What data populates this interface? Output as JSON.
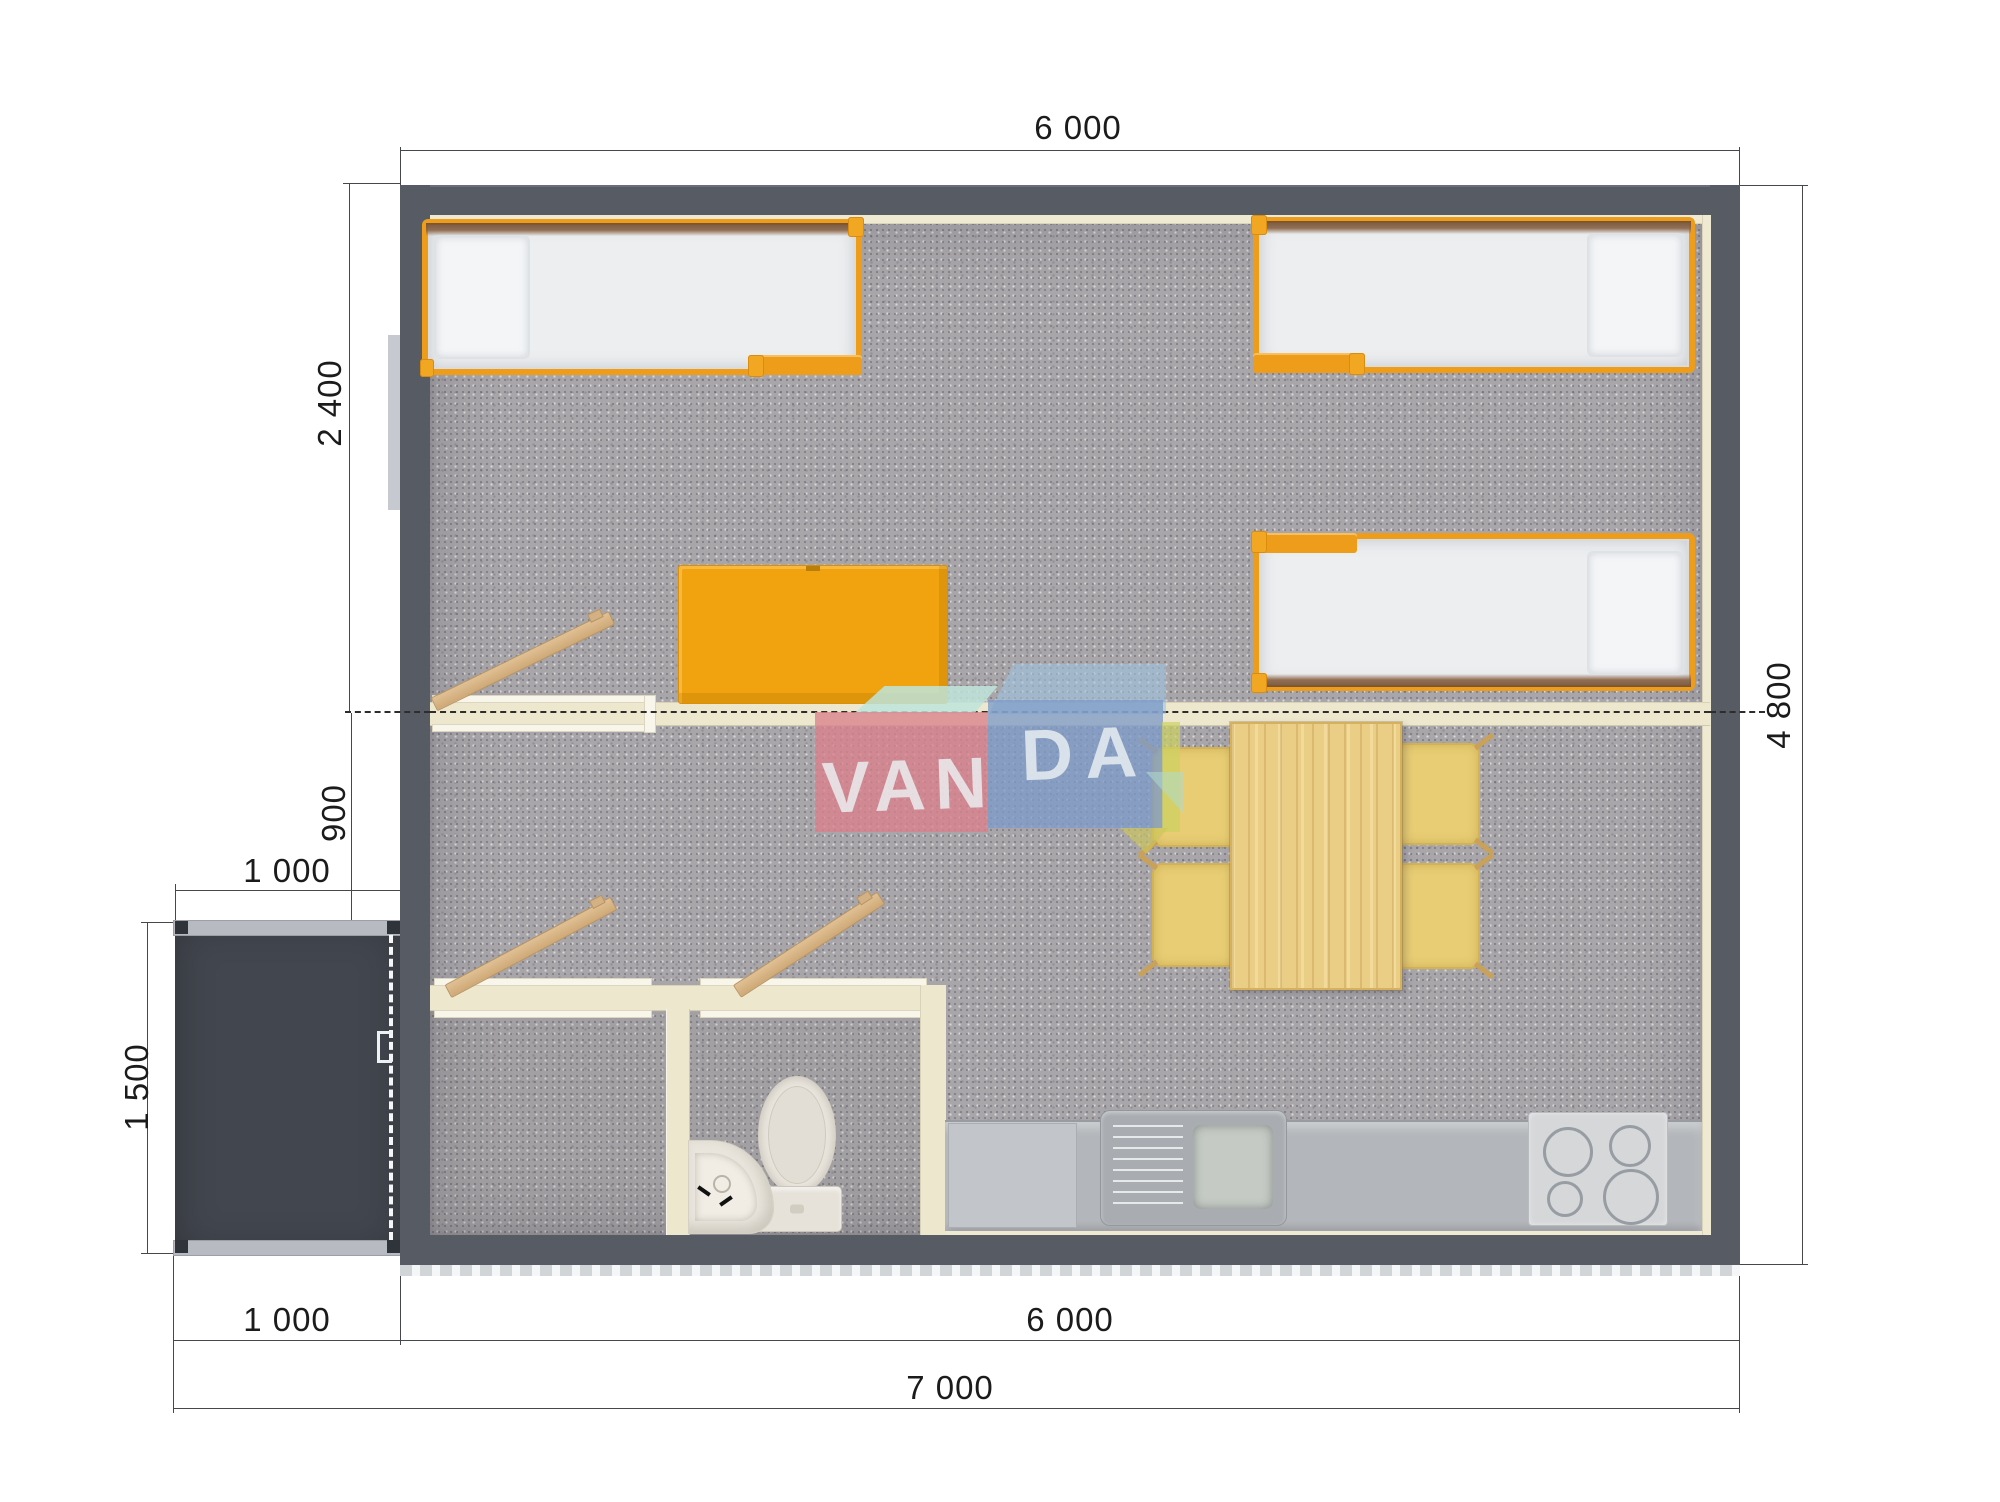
{
  "document": {
    "type": "architectural-floor-plan-top-view",
    "units": "mm"
  },
  "watermark": {
    "text": "VANDA",
    "left": "VAN",
    "right": "DA"
  },
  "dimensions": {
    "top_house_width": "6 000",
    "right_house_depth": "4 800",
    "bedroom_depth": "2 400",
    "hallway_depth": "900",
    "porch_width": "1 000",
    "porch_depth": "1 500",
    "bottom_porch_width": "1 000",
    "bottom_house_width": "6 000",
    "bottom_total_width": "7 000"
  },
  "colors": {
    "wall": "#575b64",
    "porch": "#42464e",
    "floor_carpet": "#a9a6aa",
    "interior_wall_cream": "#ede7ce",
    "accent_orange": "#ee9d1a",
    "door_wood": "#d8b88a",
    "table_wood": "#eace85",
    "chair_yellow": "#e8cd74",
    "counter_gray": "#b3b6ba",
    "watermark_pink": "#db828c",
    "watermark_blue": "#7d9bc8",
    "watermark_mint": "#b9e1d7"
  }
}
